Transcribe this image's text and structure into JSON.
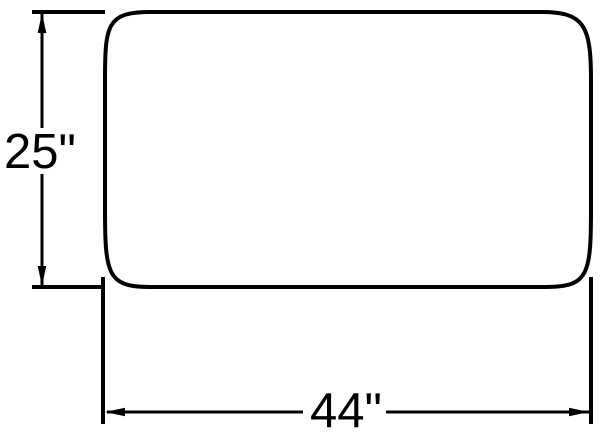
{
  "page": {
    "background_color": "#ffffff"
  },
  "diagram": {
    "type": "technical-dimension-drawing",
    "shape": "rounded-rectangle",
    "line_color": "#000000",
    "dimensions": {
      "height": {
        "label": "25\"",
        "value": 25,
        "unit": "inches"
      },
      "width": {
        "label": "44\"",
        "value": 44,
        "unit": "inches"
      }
    }
  }
}
